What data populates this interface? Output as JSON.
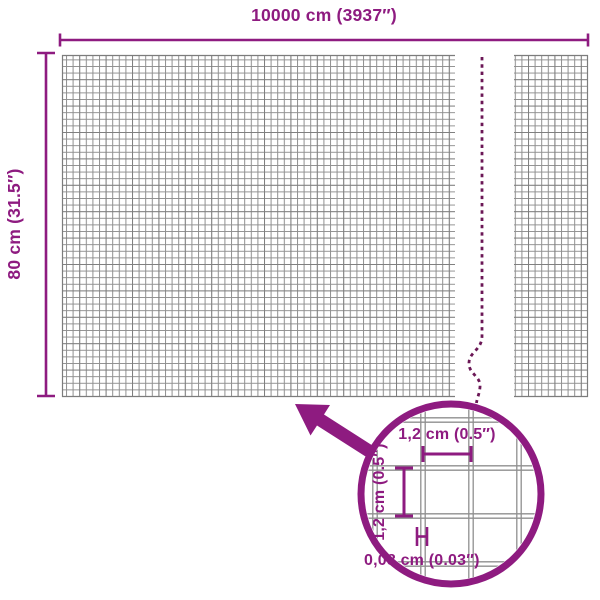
{
  "title": "Mesh fence dimension diagram",
  "overall": {
    "width_label": "10000 cm (3937″)",
    "height_label": "80 cm (31.5″)"
  },
  "detail": {
    "cell_width_label": "1,2 cm (0.5″)",
    "cell_height_label": "1,2 cm (0.5″)",
    "wire_thickness_label": "0,08 cm (0.03″)"
  },
  "colors": {
    "accent": "#8e1b80",
    "dash": "#6b1756",
    "grid_line": "#8f8f8f",
    "grid_line_dark": "#6f6f6f",
    "panel_border": "#7c7c7c",
    "background": "#ffffff"
  }
}
